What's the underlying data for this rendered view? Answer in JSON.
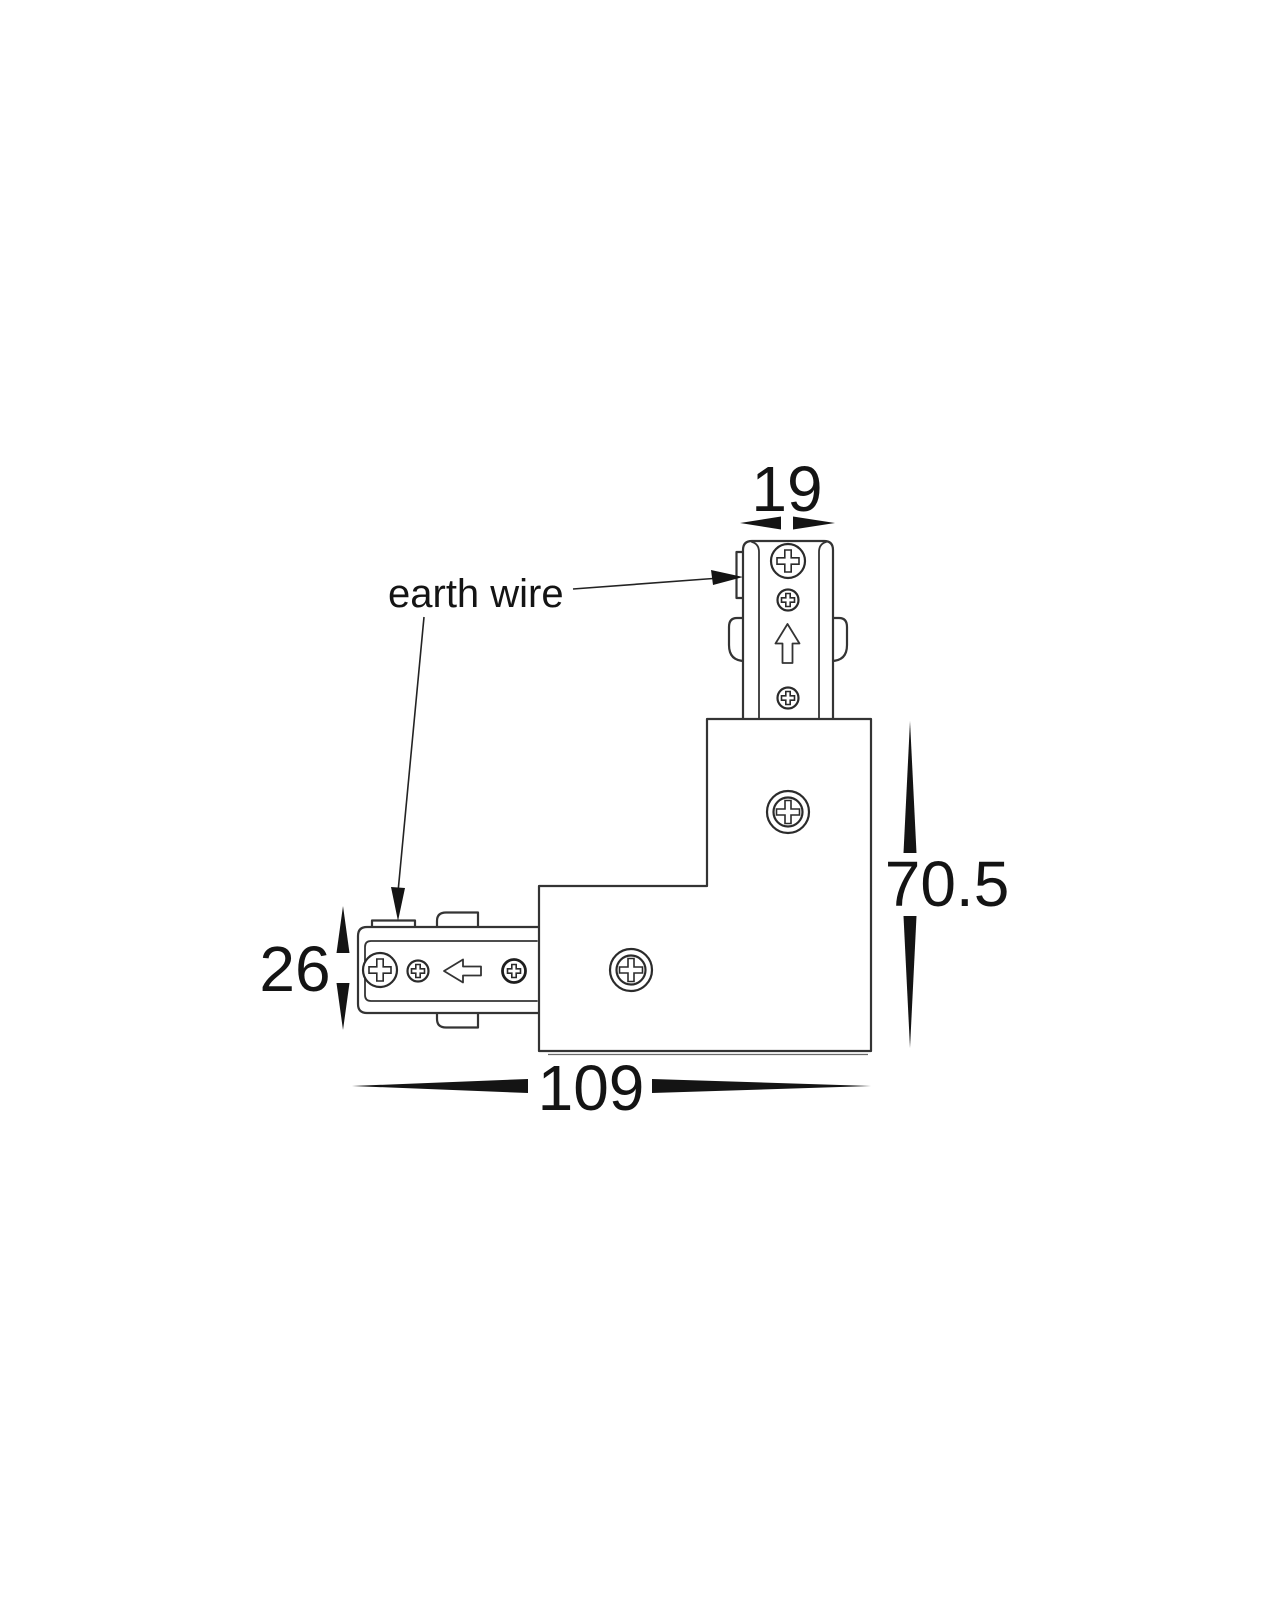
{
  "figure": {
    "title": "l-shaped-track-connector-dimension-drawing",
    "labels": {
      "earth_wire": "earth wire"
    },
    "dimensions": {
      "stem_width": "19",
      "body_height": "70.5",
      "connector_height": "26",
      "overall_width": "109"
    },
    "icons": {
      "phillips_screw": "⊕",
      "direction_arrow_up": "⇧",
      "direction_arrow_left": "⇦",
      "leader_arrow": "➤",
      "dimension_spike": "◆"
    },
    "colors": {
      "background": "#ffffff",
      "line": "#343434",
      "ink": "#141414"
    }
  }
}
